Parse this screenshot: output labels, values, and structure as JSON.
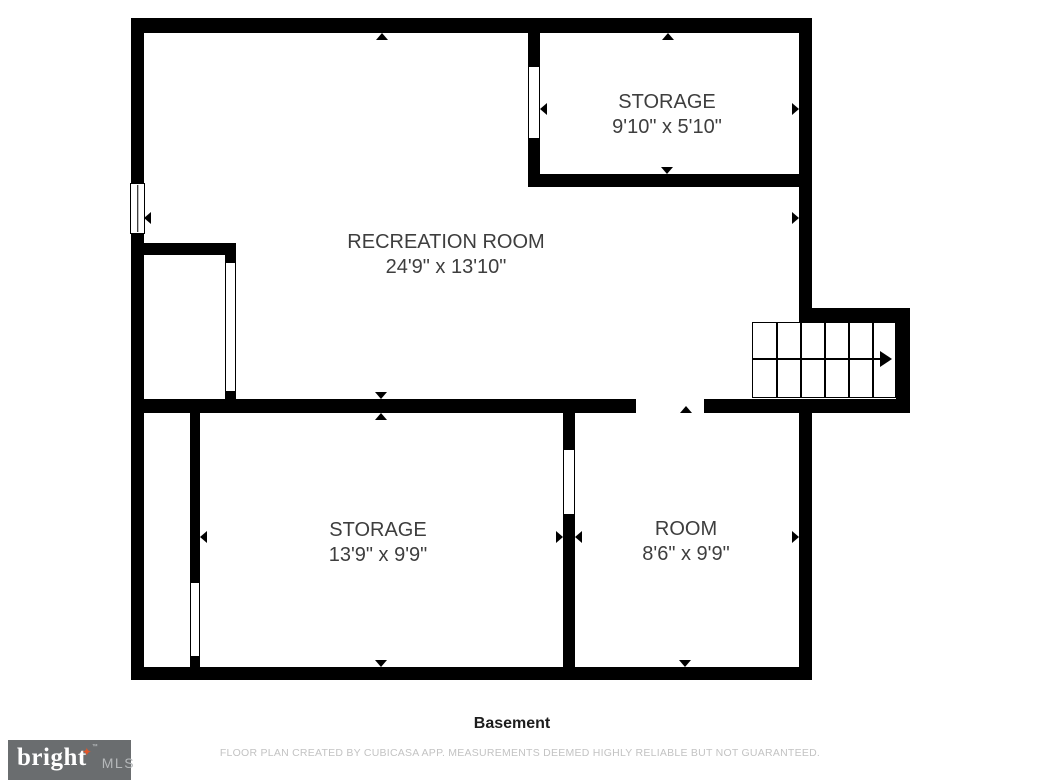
{
  "floor_plan": {
    "rooms": [
      {
        "name": "STORAGE",
        "dimensions": "9'10\" x 5'10\""
      },
      {
        "name": "RECREATION ROOM",
        "dimensions": "24'9\" x 13'10\""
      },
      {
        "name": "STORAGE",
        "dimensions": "13'9\" x 9'9\""
      },
      {
        "name": "ROOM",
        "dimensions": "8'6\" x 9'9\""
      }
    ],
    "floor_label": "Basement",
    "disclaimer": "FLOOR PLAN CREATED BY CUBICASA APP. MEASUREMENTS DEEMED HIGHLY RELIABLE BUT NOT GUARANTEED."
  },
  "logo": {
    "brand": "bright",
    "trademark_symbol": "™",
    "suffix": "MLS"
  },
  "colors": {
    "wall": "#000000",
    "room_label": "#3e3e3e",
    "floor_label": "#1d1d1d",
    "disclaimer": "#c3c3c3",
    "logo_background": "#6a6d6f",
    "logo_star": "#e0562a",
    "logo_brand": "#ffffff",
    "logo_suffix": "#b5b8ba"
  }
}
